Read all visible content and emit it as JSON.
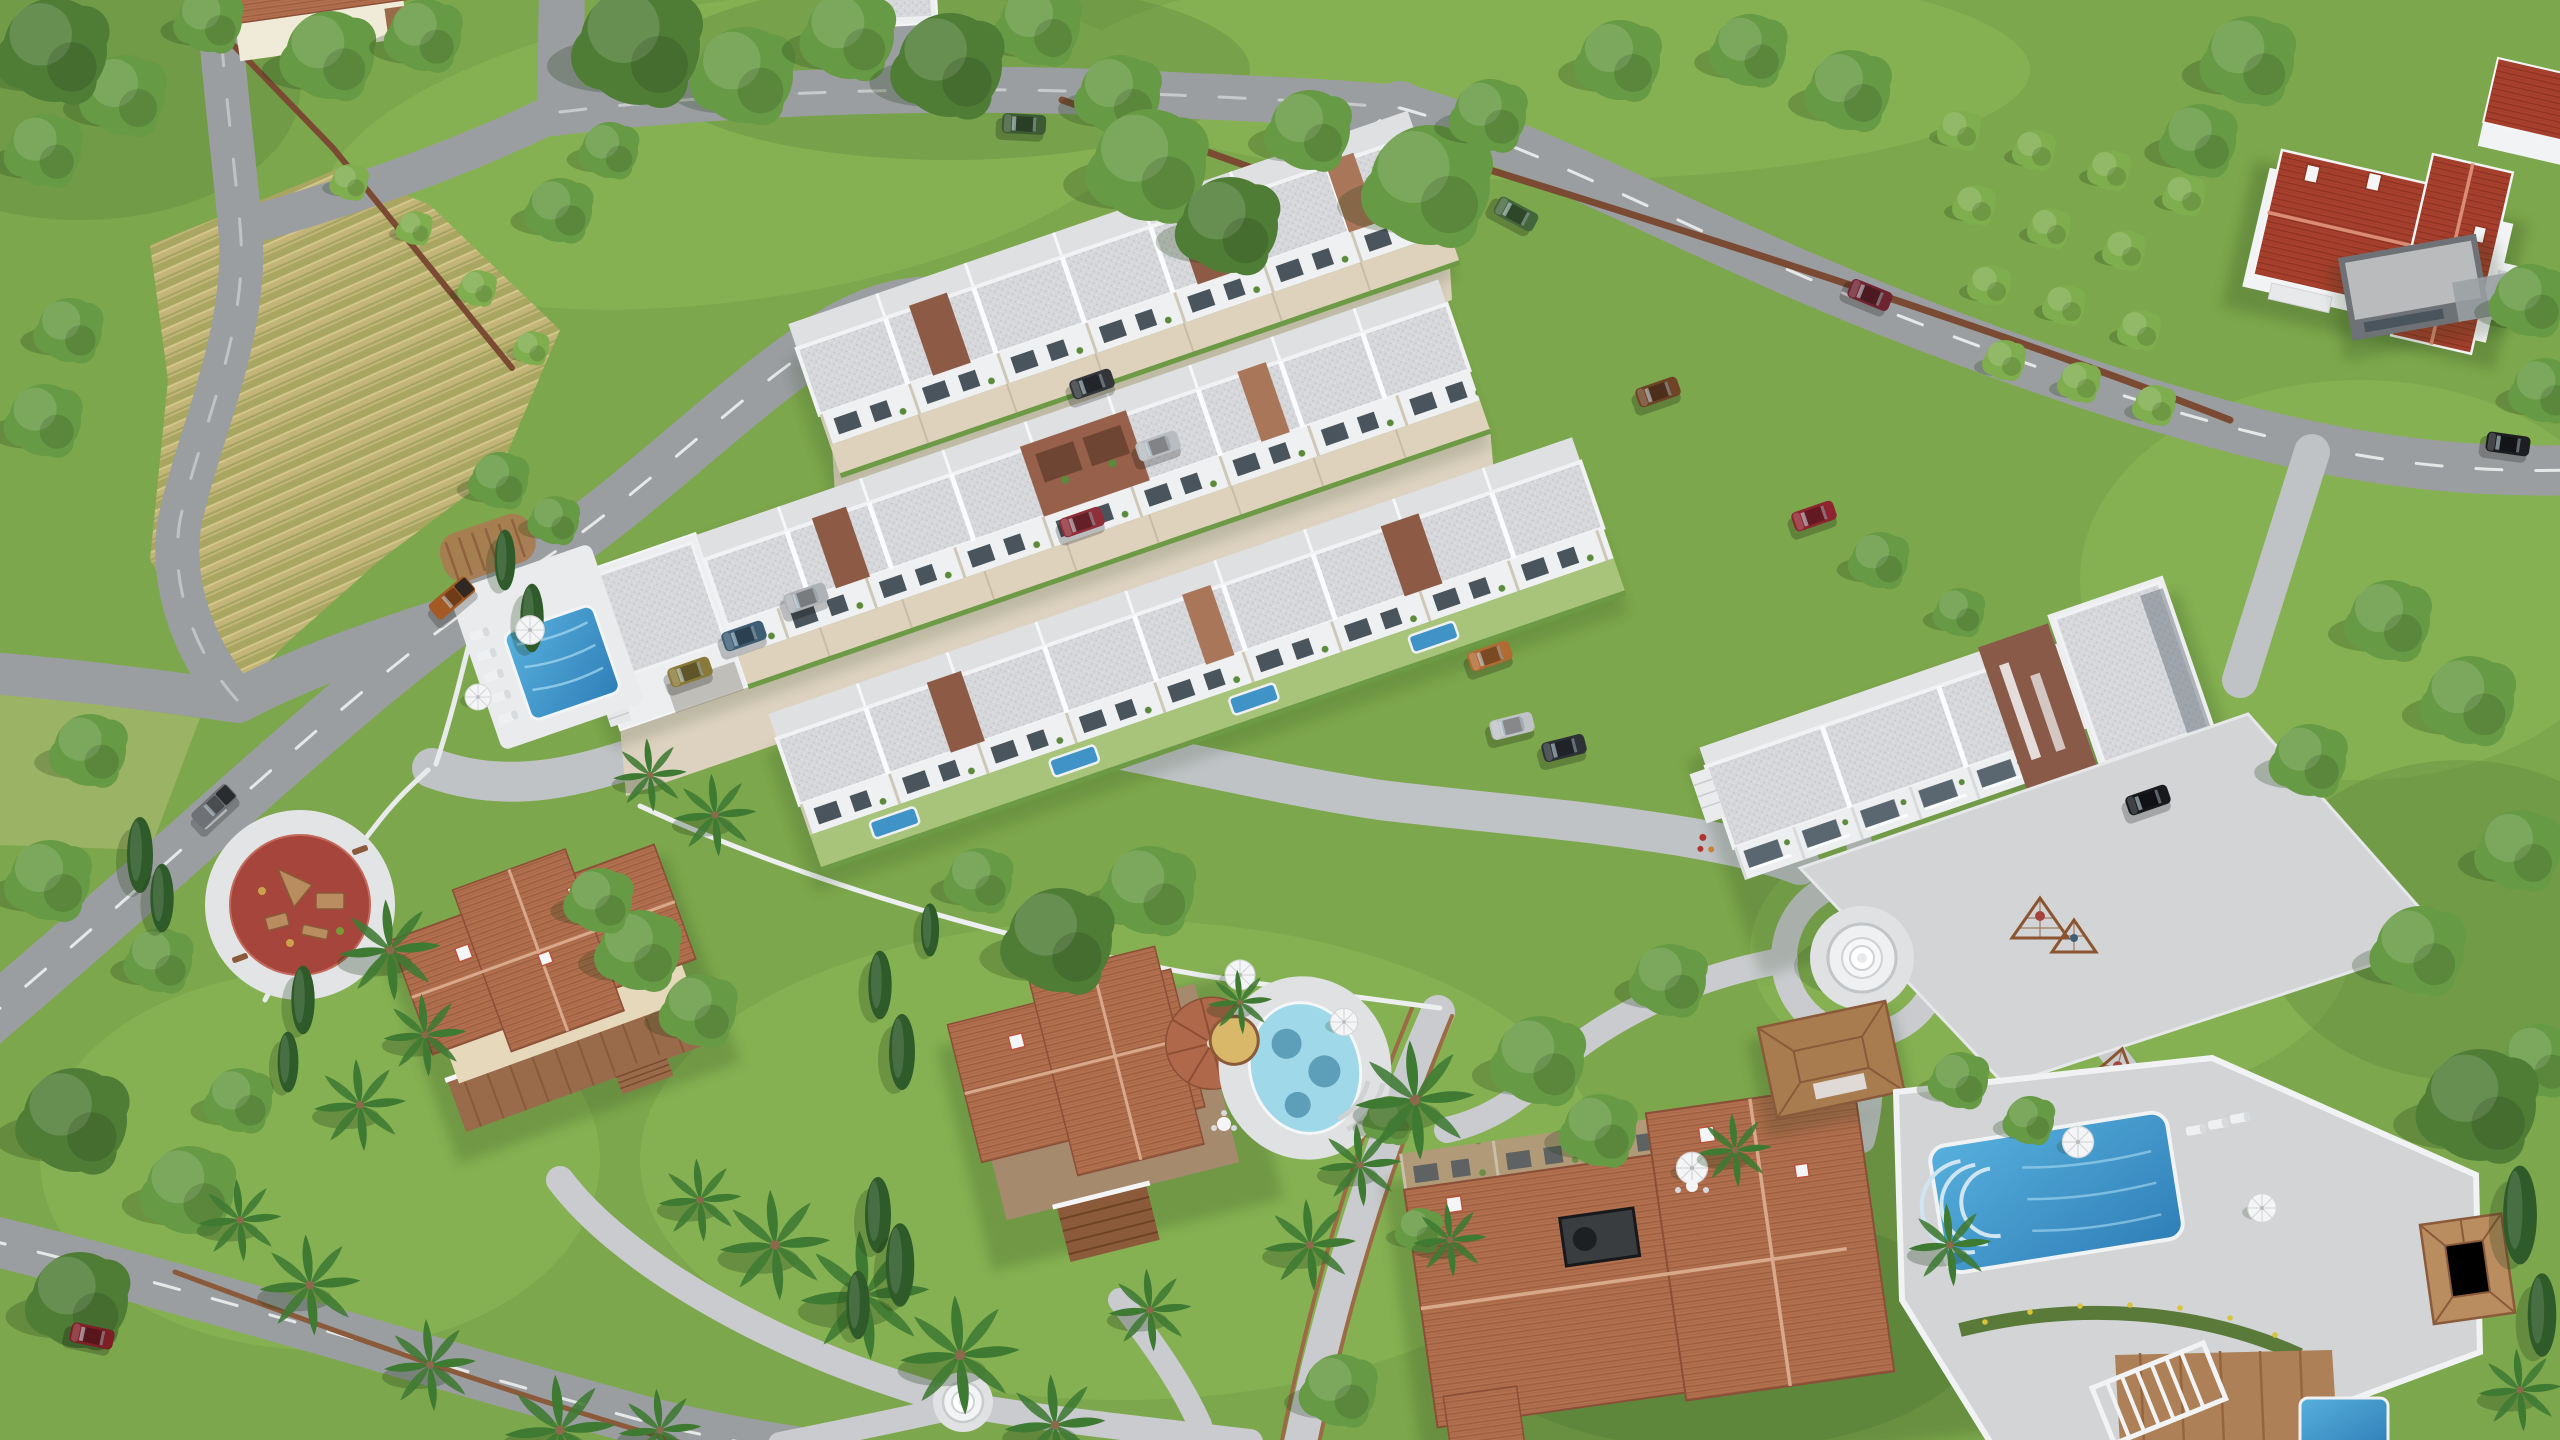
{
  "scene": {
    "title": "Aerial 3D render of a suburban residential development with townhouse rows, villas, pools and gardens",
    "view": "bird's-eye three-quarter aerial",
    "environment": "sunny daytime, green lawns, roads, plowed field, palms and cypresses",
    "development": {
      "townhouse_rows": 3,
      "apartment_block_floors": 3,
      "detached_villas": 4,
      "neighboring_houses": 3
    }
  },
  "palette": {
    "grass_base": "#7da74c",
    "grass_light": "#8fbc58",
    "grass_dark": "#55823a",
    "field_tan": "#c3b577",
    "road": "#9b9ea1",
    "road_mark": "#ffffff",
    "path": "#c9cbce",
    "paving": "#d2d4d6",
    "cobble": "#c0c3c6",
    "roof_gravel": "#d6d7da",
    "parapet": "#f1f2f4",
    "wall_white": "#eef0f1",
    "wall_beige": "#ded2bd",
    "accent_brown": "#8d5a45",
    "accent_tan": "#a9765a",
    "window": "#4a545c",
    "terracotta": "#b2704e",
    "roof_red": "#a8402e",
    "wall_cream": "#e6d8ba",
    "wall_taupe": "#a58a6d",
    "wood": "#a97c50",
    "wood_dark": "#8a5a3a",
    "fence_brown": "#7a4a33",
    "pool_blue": "#3f93c7",
    "pool_mosaic": "#9fd8e8",
    "deck_white": "#e9ebed",
    "playground_red": "#a6453b",
    "fountain_white": "#eef0f2",
    "tree_dark": "#4f7d36",
    "tree_mid": "#679a44",
    "tree_light": "#7fae4e",
    "palm_green": "#3f7a33",
    "cypress_green": "#2f5a2a",
    "shadow_green": "#1e3a14"
  },
  "vehicles": [
    {
      "name": "pickup truck",
      "color": "orange-brown",
      "hex": "#a35a24"
    },
    {
      "name": "pickup truck",
      "color": "gray",
      "hex": "#6e7276"
    },
    {
      "name": "sedan",
      "color": "dark red",
      "hex": "#7e1f26"
    },
    {
      "name": "suv",
      "color": "dark green",
      "hex": "#3c5a34"
    },
    {
      "name": "hatchback",
      "color": "green",
      "hex": "#44663c"
    },
    {
      "name": "sedan",
      "color": "maroon",
      "hex": "#6e2430"
    },
    {
      "name": "sedan",
      "color": "black",
      "hex": "#1c1e22"
    },
    {
      "name": "suv",
      "color": "dark gray",
      "hex": "#32363b"
    },
    {
      "name": "suv",
      "color": "silver",
      "hex": "#b9bcc0"
    },
    {
      "name": "sedan",
      "color": "red",
      "hex": "#8e2f39"
    },
    {
      "name": "suv",
      "color": "brown",
      "hex": "#6e4326"
    },
    {
      "name": "sedan",
      "color": "orange",
      "hex": "#b06a32"
    },
    {
      "name": "suv",
      "color": "silver",
      "hex": "#c0c3c6"
    },
    {
      "name": "suv",
      "color": "dark gray",
      "hex": "#2d3237"
    },
    {
      "name": "minivan",
      "color": "olive",
      "hex": "#8a7a3a"
    },
    {
      "name": "suv",
      "color": "steel blue",
      "hex": "#3e5e75"
    },
    {
      "name": "suv",
      "color": "silver",
      "hex": "#aeb2b6"
    },
    {
      "name": "suv",
      "color": "black",
      "hex": "#17191d"
    },
    {
      "name": "sedan",
      "color": "red",
      "hex": "#8e2430"
    }
  ],
  "amenities": [
    "communal swimming pool",
    "private plunge pools",
    "oval mosaic pool",
    "lap pool",
    "children's playground",
    "climbing nets",
    "tiered fountain",
    "garden fountain",
    "wooden gazebo",
    "poolside gazebo",
    "curved pergola",
    "white pergola",
    "sun loungers",
    "parasols",
    "wooden deck",
    "hot tub"
  ]
}
